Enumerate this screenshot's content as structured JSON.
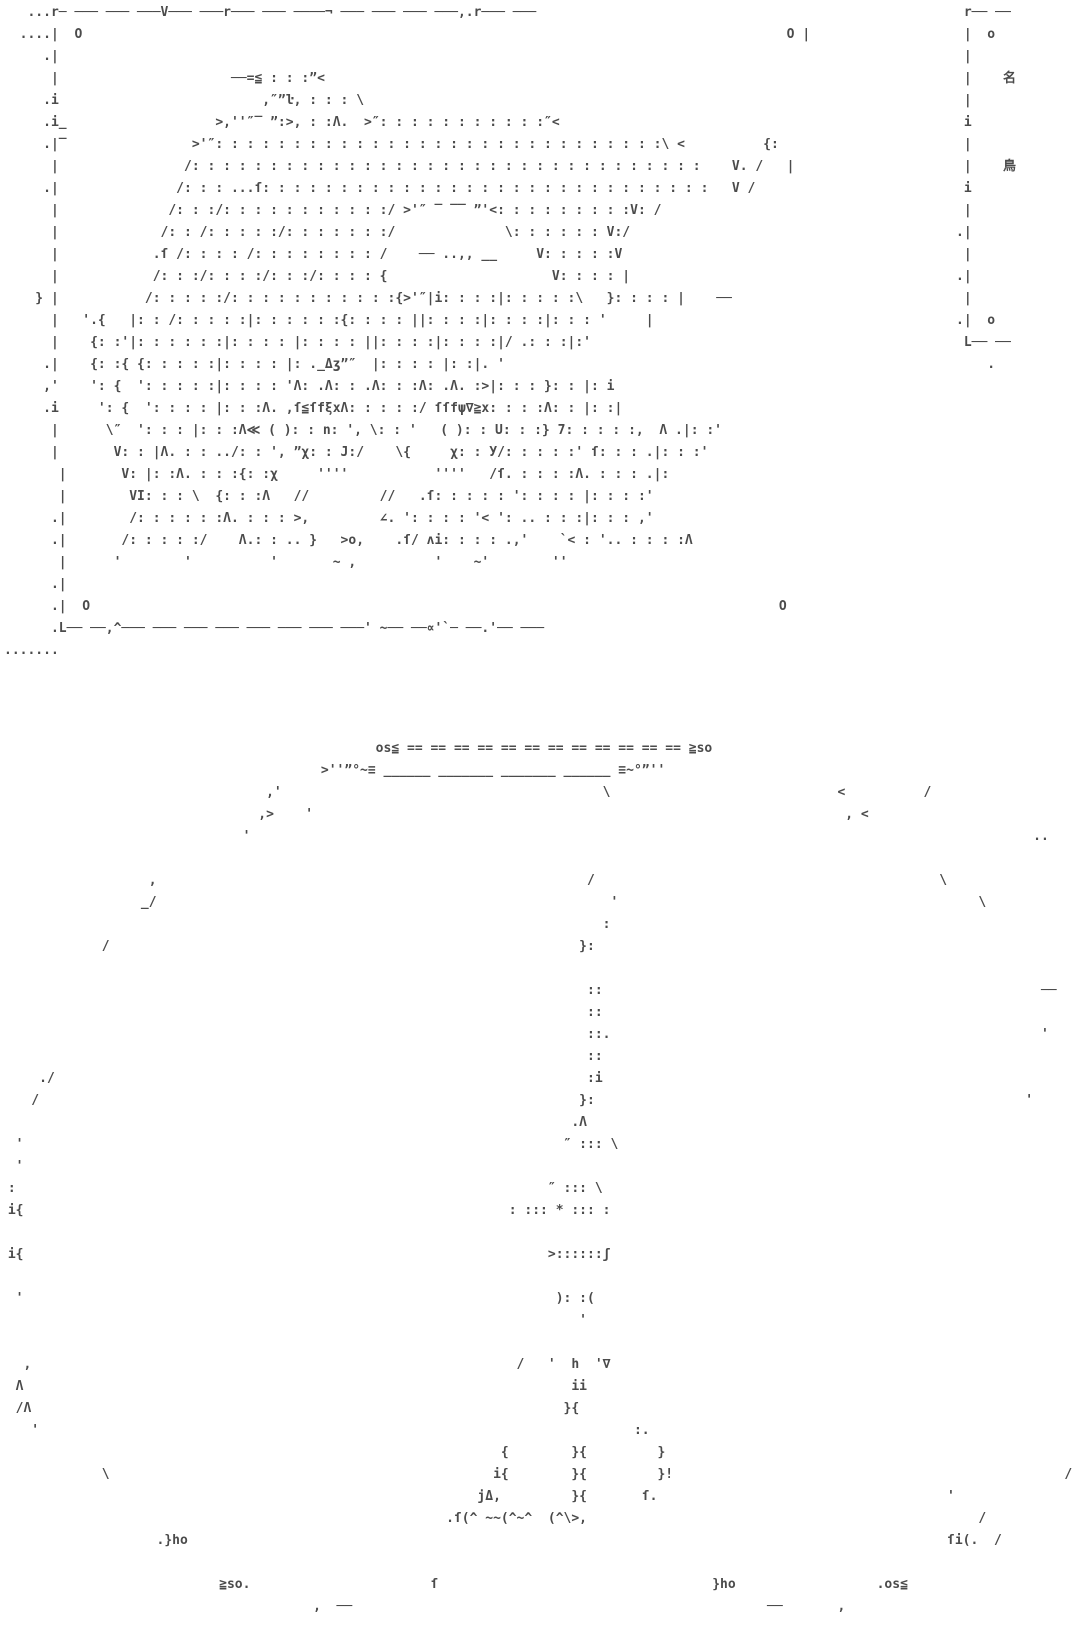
{
  "page": {
    "background": "#ffffff",
    "ink": "#4b4b4b"
  },
  "portrait_frame": {
    "corner_marks": [
      "O",
      "O",
      "O",
      "O"
    ],
    "lines": [
      "   ...r─ ─── ─── ───V─── ───r─── ─── ────¬ ─── ─── ─── ───,.r─── ───",
      "  ....|  O                                                                                          O |",
      "     .|",
      "      |                      ──=≦ : : :”<",
      "     .i                          ,″”ŀ, : : : \\",
      "     .i_                   >,''″‾ ”:>, : :Λ.  >″: : : : : : : : : : :″<",
      "     .|‾                >'″: : : : : : : : : : : : : : : : : : : : : : : : : : : : :\\ <          {:",
      "      |                /: : : : : : : : : : : : : : : : : : : : : : : : : : : : : : : : :    V. /   |",
      "     .|               /: : : ...ſ: : : : : : : : : : : : : : : : : : : : : : : : : : : : :   V /",
      "      |              /: : :/: : : : : : : : : : :/ >'″ ‾ ‾‾ ”'<: : : : : : : : :V: /",
      "      |             /: : /: : : : :/: : : : : : :/              \\: : : : : : V:/",
      "      |            .ſ /: : : : /: : : : : : : : /    ── ..,, __     V: : : : :V",
      "      |            /: : :/: : : :/: : :/: : : : {                     V: : : : |",
      "    } |           /: : : : :/: : : : : : : : : : :{>'″|i: : : :|: : : : :\\   }: : : : |    ──",
      "      |   '.{   |: : /: : : : :|: : : : : :{: : : : ||: : : :|: : : :|: : : '     |",
      "      |    {: :'|: : : : : :|: : : : |: : : : ||: : : :|: : : :|/ .: : :|:'",
      "     .|    {: :{ {: : : : :|: : : : |: ._Δʒ”″  |: : : : |: :|. '",
      "     ,'    ': {  ': : : : :|: : : : 'Λ: .Λ: : .Λ: : :Λ: .Λ. :>|: : : }: : |: i",
      "     .i     ': {  ': : : : |: : :Λ. ,ſ≦ſfξxΛ: : : : :/ ſſfψ∇≧x: : : :Λ: : |: :|",
      "      |      \\″  ': : : |: : :Λ≪ ( ): : n: ', \\: : '   ( ): : U: : :} 7: : : : :,  Λ .|: :'",
      "      |       V: : |Λ. : : ../: : ', ”χ: : J:/    \\{     χ: : У/: : : : :' ſ: : : .|: : :'",
      "       |       V: |: :Λ. : : :{: :χ     ''''           ''''   /ſ. : : : :Λ. : : : .|:",
      "       |        VI: : : \\  {: : :Λ   //         //   .ſ: : : : : ': : : : |: : : :'",
      "      .|        /: : : : : :Λ. : : : >,         ∠. ': : : : '< ': .. : : :|: : : ,'",
      "      .|       /: : : : :/    Λ.: : .. }   >o,    .ſ/ ʌi: : : : .,'    `< : '.. : : : :Λ",
      "       |      '        '          '       ~ ,          '    ~'        ''",
      "      .|",
      "      .|  O                                                                                        O",
      "      .L── ──,^─── ─── ─── ─── ─── ─── ─── ───' ~── ──∝'`─ ──.'── ───",
      "......."
    ]
  },
  "side_frame": {
    "kanji_labels": [
      "名",
      "鳥"
    ],
    "corner_marks": [
      "o",
      "o"
    ],
    "lines": [
      " r── ──",
      " |  o",
      " |",
      " |    名",
      " |",
      " i",
      " |",
      " |    鳥",
      " i",
      " |",
      ".|",
      " |",
      ".|",
      " |",
      ".|  o",
      " L── ──",
      "    ."
    ]
  },
  "dome": {
    "crown_text": "os≦ == == == == == == == == == == == == ≧so",
    "lines": [
      "                                                os≦ == == == == == == == == == == == == ≧so",
      "                                         >''”°~≡ ______ _______ _______ ______ ≡~°”''",
      "                                  ,'                                         \\                             <          /",
      "                                 ,>    '                                                                    , <",
      "                               '                                                                                                    ..",
      "",
      "                   ,                                                       /                                            \\",
      "                  _/                                                          '                                              \\",
      "                                                                             :",
      "             /                                                            }:",
      "",
      "                                                                           ::                                                        ──",
      "                                                                           ::",
      "                                                                           ::.                                                       '",
      "                                                                           ::",
      "     ./                                                                    :i",
      "    /                                                                     }:                                                       '",
      "                                                                         .Λ",
      "  '                                                                     ″ ::: \\",
      "  '",
      " :                                                                    ″ ::: \\",
      " i{                                                              : ::: * ::: :",
      "",
      " i{                                                                   >::::::ʃ",
      "",
      "  '                                                                    ): :(",
      "                                                                          '",
      "",
      "   ,                                                              /   '  h  '∇",
      "  Λ                                                                      ii",
      "  /Λ                                                                    }{",
      "    '                                                                            :.",
      "                                                                {        }{         }",
      "             \\                                                 i{        }{         }!                                                  /",
      "                                                             jΔ,         }{       ſ.                                     '",
      "                                                         .ſ(^ ~~(^~^  (^\\>,                                                  /",
      "                    .}ho                                                                                                 ſi(.  /",
      "",
      "                            ≧so.                       ſ                                   }ho                  .os≦",
      "                                        ,  ──                                                     ──       ,",
      ""
    ]
  }
}
